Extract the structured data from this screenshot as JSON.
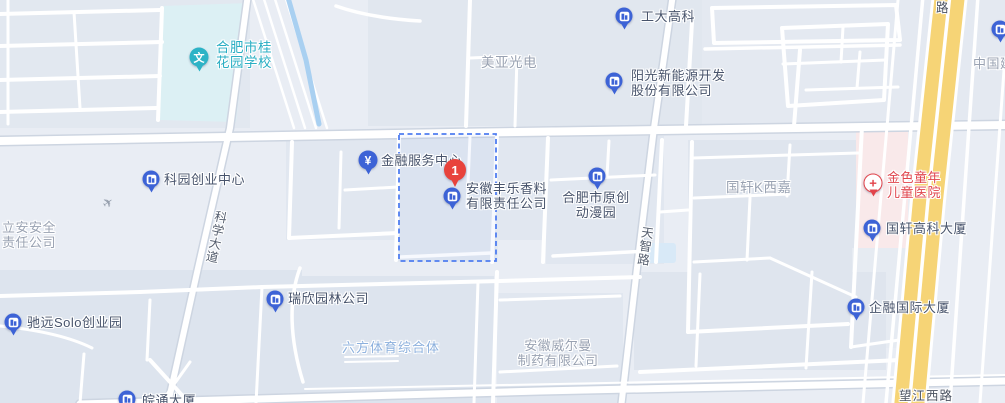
{
  "map": {
    "selected_pin": {
      "number": "1"
    },
    "glyphs": {
      "school": "文",
      "finance": "¥",
      "hospital_cross": "+",
      "plane": "✈"
    },
    "colors": {
      "poi_blue": "#3d63d6",
      "selected_red": "#e8433c",
      "school_teal": "#2cb3c6",
      "hospital_red": "#e2434a",
      "highway_yellow": "#f6d476",
      "boundary_blue": "#4f7df0",
      "water_blue": "#a9d0f1"
    },
    "pois": {
      "school": {
        "line1": "合肥市桂",
        "line2": "花园学校"
      },
      "gongda": {
        "label": "工大高科"
      },
      "yangguang": {
        "line1": "阳光新能源开发",
        "line2": "股份有限公司"
      },
      "keyuan": {
        "label": "科园创业中心"
      },
      "jinrong": {
        "label": "金融服务中心"
      },
      "fengle": {
        "line1": "安徽丰乐香料",
        "line2": "有限责任公司"
      },
      "yuanchuang": {
        "line1": "合肥市原创",
        "line2": "动漫园"
      },
      "hospital": {
        "line1": "金色童年",
        "line2": "儿童医院"
      },
      "guoxuan_tower": {
        "label": "国轩高科大厦"
      },
      "ruixin": {
        "label": "瑞欣园林公司"
      },
      "chiyuan": {
        "label": "驰远Solo创业园"
      },
      "qirong": {
        "label": "企融国际大厦"
      },
      "wantong": {
        "label": "皖通大厦"
      }
    },
    "area_labels": {
      "meiya": {
        "label": "美亚光电"
      },
      "lian": {
        "line1": "立安安全",
        "line2": "责任公司"
      },
      "guoxuan_k": {
        "label": "国轩K西嘉"
      },
      "liufang": {
        "label": "六方体育综合体"
      },
      "weierman": {
        "line1": "安徽威尔曼",
        "line2": "制药有限公司"
      },
      "zhongguo": {
        "label": "中国建"
      }
    },
    "road_labels": {
      "kexue_dadao": "科学大道",
      "tianzhi_lu": "天智路",
      "wangjiang_xilu": "望江西路",
      "partial_top": "路"
    }
  }
}
